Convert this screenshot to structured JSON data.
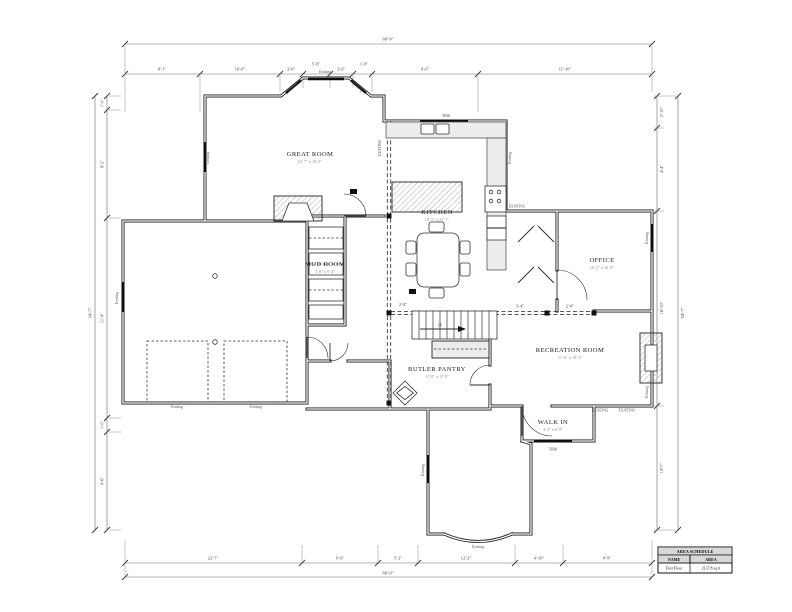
{
  "rooms": {
    "great_room": {
      "name": "GREAT ROOM",
      "size": "21' 7\" x 16' 8\""
    },
    "kitchen": {
      "name": "KITCHEN",
      "size": "13' 5\" x 21' 7\""
    },
    "mud_room": {
      "name": "MUD ROOM",
      "size": "3' 8\" x 6' 4\""
    },
    "office": {
      "name": "OFFICE",
      "size": "10' 2\" x 12' 8\""
    },
    "recreation_room": {
      "name": "RECREATION ROOM",
      "size": "11' 6\" x 18' 2\""
    },
    "butler_pantry": {
      "name": "BUTLER PANTRY",
      "size": "11' 8\" x 11' 8\""
    },
    "walk_in": {
      "name": "WALK IN",
      "size": "4' 2\" x 6' 8\""
    }
  },
  "labels": {
    "existing_caps": "EXISTING",
    "existing": "Existing",
    "up": "UP",
    "window_tag_kitchen": "5036",
    "window_tag_walkin": "5036"
  },
  "dimensions": {
    "top": {
      "overall": "60'-9\"",
      "segments": [
        "8'-1\"",
        "10'-8\"",
        "3'-0\"",
        "5'-8\"",
        "3'-0\"",
        "1'-8\"",
        "9'-6\"",
        "11'-10\""
      ]
    },
    "bottom": {
      "overall": "60'-9\"",
      "segments": [
        "22'-7\"",
        "9'-6\"",
        "5'-2\"",
        "12'-2\"",
        "4'-10\"",
        "8'-9\""
      ]
    },
    "left": {
      "overall": "34'-7\"",
      "segments": [
        "1'-0\"",
        "8'-2\"",
        "11'-4\"",
        "1'-0\"",
        "9'-6\""
      ]
    },
    "right": {
      "overall": "34'-7\"",
      "segments": [
        "2'-10\"",
        "4'-4\"",
        "16'-10\"",
        "10'-7\""
      ]
    },
    "beam": {
      "a": "2'-8\"",
      "b": "3'-4\"",
      "c": "2'-8\""
    }
  },
  "schedule": {
    "title": "AREA SCHEDULE",
    "columns": [
      "NAME",
      "AREA"
    ],
    "rows": [
      {
        "name": "First Floor",
        "area": "2137.8 sq ft"
      }
    ]
  }
}
